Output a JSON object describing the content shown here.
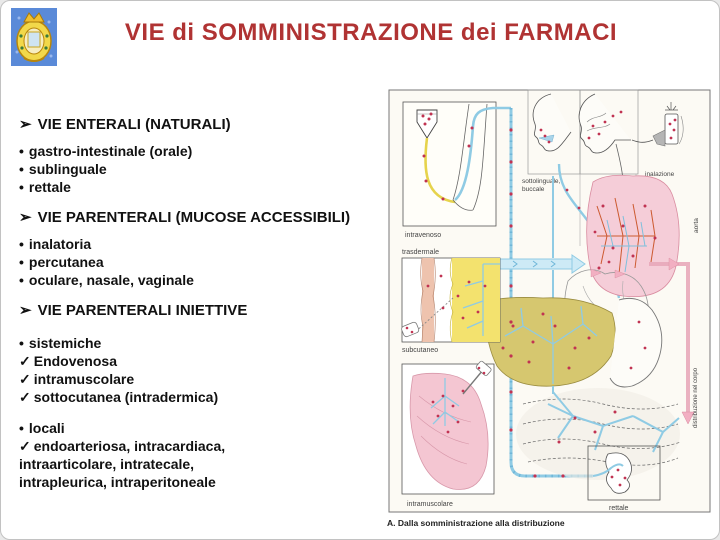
{
  "slide": {
    "title": "VIE di SOMMINISTRAZIONE dei FARMACI"
  },
  "logo": {
    "name": "university-crest"
  },
  "outline": {
    "sections": [
      {
        "marker": "➢",
        "heading": "VIE ENTERALI (NATURALI)",
        "items": [
          {
            "marker": "•",
            "text": "gastro-intestinale (orale)"
          },
          {
            "marker": "•",
            "text": "sublinguale"
          },
          {
            "marker": "•",
            "text": "rettale"
          }
        ]
      },
      {
        "marker": "➢",
        "heading": "VIE PARENTERALI (MUCOSE ACCESSIBILI)",
        "items": [
          {
            "marker": "•",
            "text": "inalatoria"
          },
          {
            "marker": "•",
            "text": "percutanea"
          },
          {
            "marker": "•",
            "text": "oculare, nasale, vaginale"
          }
        ]
      },
      {
        "marker": "➢",
        "heading": "VIE PARENTERALI INIETTIVE",
        "groups": [
          {
            "marker": "•",
            "label": "sistemiche",
            "checks": [
              {
                "marker": "✓",
                "text": "Endovenosa"
              },
              {
                "marker": "✓",
                "text": "intramuscolare"
              },
              {
                "marker": "✓",
                "text": "sottocutanea (intradermica)"
              }
            ]
          },
          {
            "marker": "•",
            "label": "locali",
            "checks": [
              {
                "marker": "✓",
                "text": "endoarteriosa, intracardiaca, intraarticolare, intratecale, intrapleurica, intraperitoneale"
              }
            ]
          }
        ]
      }
    ]
  },
  "diagram": {
    "labels": {
      "intravenoso": "intravenoso",
      "sottolinguale": "sottolinguale,",
      "buccale": "buccale",
      "inalazione": "inalazione",
      "per_os": "per os",
      "aorta": "aorta",
      "trasdermale": "trasdermale",
      "subcutaneo": "subcutaneo",
      "distribuzione": "distribuzione nel corpo",
      "intramuscolare": "intramuscolare",
      "rettale": "rettale"
    },
    "caption": "A. Dalla somministrazione alla distribuzione"
  },
  "colors": {
    "title_red": "#b03333",
    "vessel_blue": "#8fcbe4",
    "drug_dot_red": "#c13352",
    "lung_pink": "#f5cdd8",
    "liver_olive": "#d6c76f",
    "muscle_pink": "#f4c6d2",
    "iv_tube_yellow": "#e6d34c"
  }
}
